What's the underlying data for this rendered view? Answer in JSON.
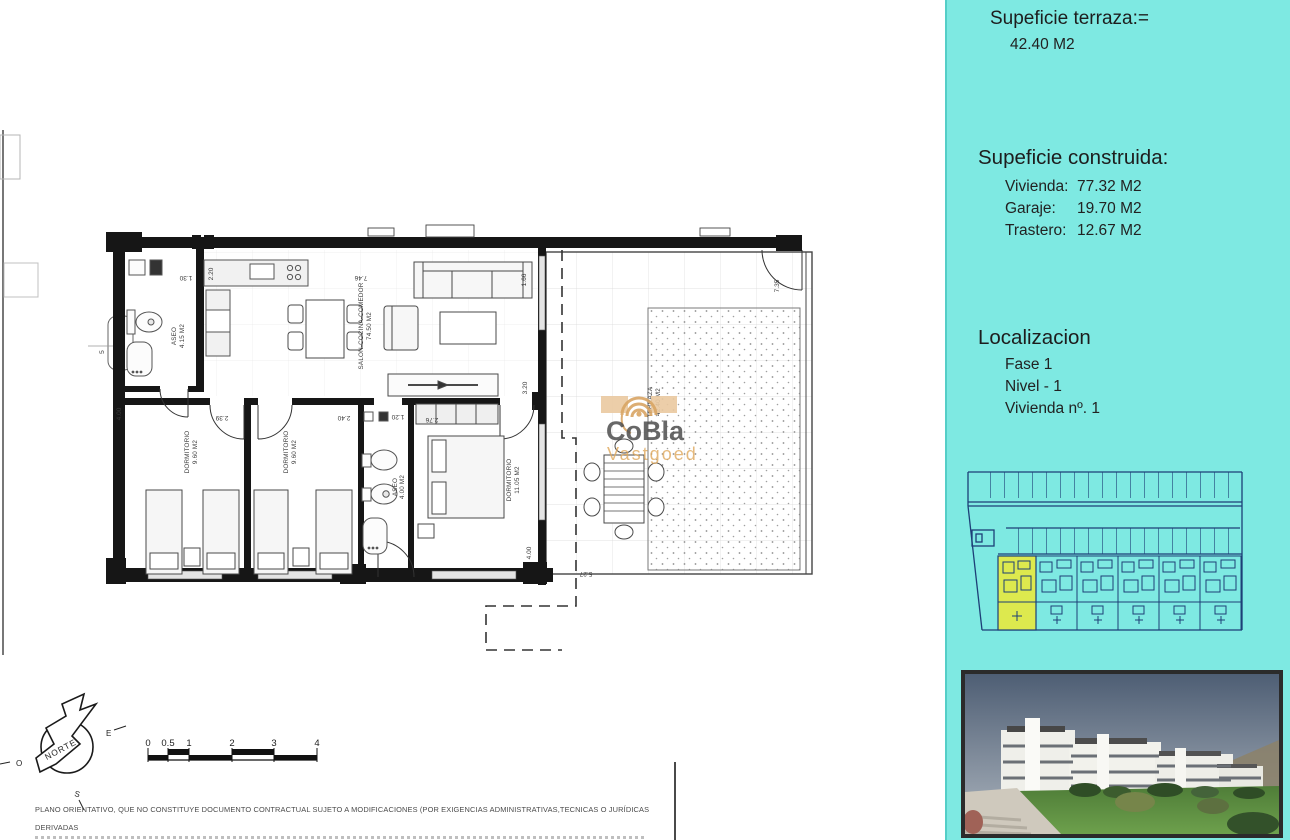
{
  "right_panel": {
    "terrace": {
      "title": "Supeficie terraza:=",
      "value": "42.40 M2"
    },
    "built": {
      "title": "Supeficie construida:",
      "rows": [
        {
          "label": "Vivienda:",
          "value": "77.32 M2"
        },
        {
          "label": "Garaje:",
          "value": "19.70 M2"
        },
        {
          "label": "Trastero:",
          "value": "12.67 M2"
        }
      ]
    },
    "location": {
      "title": "Localizacion",
      "rows": [
        "Fase 1",
        "Nivel - 1",
        "Vivienda nº. 1"
      ]
    }
  },
  "watermark": {
    "name": "CoBla",
    "sub": "Vastgoed",
    "accent": "#dfa85c",
    "gray": "#4d4d4d"
  },
  "floor_plan": {
    "rooms": [
      {
        "label": "ASEO",
        "area": "4.15 M2"
      },
      {
        "label": "SALON-COCINA-COMEDOR",
        "area": "74.50 M2"
      },
      {
        "label": "DORMITORIO",
        "area": "9.60 M2"
      },
      {
        "label": "DORMITORIO",
        "area": "9.60 M2"
      },
      {
        "label": "ASEO",
        "area": "4.00 M2"
      },
      {
        "label": "DORMITORIO",
        "area": "11.05 M2"
      },
      {
        "label": "TERRAZA",
        "area": "42.40 M2"
      }
    ],
    "dimensions": {
      "kitchen_top": "7.46",
      "aseo1_w": "1.30",
      "aseo1_h": "2.20",
      "dorm1_w": "2.39",
      "dorm2_w": "2.40",
      "bath_w": "1.20",
      "dorm3_w": "2.76",
      "living_h": "3.20",
      "window_r": "1.66",
      "dorm_h": "4.00",
      "dorm3_h": "4.00",
      "terrace_w": "5.27",
      "terrace_door": "7.35",
      "left_small": "5"
    },
    "compass": {
      "north": "NORTE",
      "east": "E",
      "west": "O",
      "south": "S"
    },
    "scale_ticks": [
      "0",
      "0.5",
      "1",
      "2",
      "3",
      "4"
    ]
  },
  "disclaimer": {
    "line1": "PLANO ORIENTATIVO, QUE NO CONSTITUYE DOCUMENTO CONTRACTUAL SUJETO A MODIFICACIONES (POR EXIGENCIAS ADMINISTRATIVAS,TECNICAS O JURÍDICAS DERIVADAS",
    "line2": "DE LA OBTENCIÓN DE LAS LICENCIAS Y PERMISOS REGLAMENTARIOS, ASÍ COMO POR NECESIDADES CONSTRUCTIVAS  O DE DISEÑO DERIVADAS DE LA DIRECCION DE LA OBRA"
  }
}
